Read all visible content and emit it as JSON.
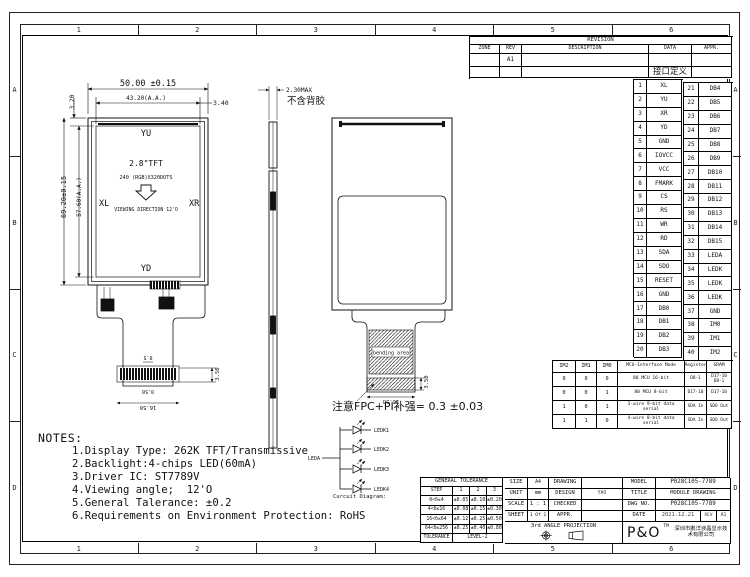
{
  "frame": {
    "top_refs": [
      "1",
      "2",
      "3",
      "4",
      "5",
      "6"
    ],
    "bottom_refs": [
      "1",
      "2",
      "3",
      "4",
      "5",
      "6"
    ],
    "left_refs": [
      "A",
      "B",
      "C",
      "D"
    ],
    "right_refs": [
      "A",
      "B",
      "C",
      "D"
    ]
  },
  "revision_table": {
    "title": "REVISION",
    "headers": [
      "ZONE",
      "REV",
      "DESCRIPTION",
      "DATA",
      "APPR."
    ],
    "row1_rev": "A1",
    "row2_data": "接口定义"
  },
  "pin_table": {
    "rows": [
      [
        "1",
        "XL",
        "21",
        "DB4"
      ],
      [
        "2",
        "YU",
        "22",
        "DB5"
      ],
      [
        "3",
        "XR",
        "23",
        "DB6"
      ],
      [
        "4",
        "YD",
        "24",
        "DB7"
      ],
      [
        "5",
        "GND",
        "25",
        "DB8"
      ],
      [
        "6",
        "IOVCC",
        "26",
        "DB9"
      ],
      [
        "7",
        "VCC",
        "27",
        "DB10"
      ],
      [
        "8",
        "FMARK",
        "28",
        "DB11"
      ],
      [
        "9",
        "CS",
        "29",
        "DB12"
      ],
      [
        "10",
        "RS",
        "30",
        "DB13"
      ],
      [
        "11",
        "WR",
        "31",
        "DB14"
      ],
      [
        "12",
        "RD",
        "32",
        "DB15"
      ],
      [
        "13",
        "SDA",
        "33",
        "LEDA"
      ],
      [
        "14",
        "SDO",
        "34",
        "LEDK"
      ],
      [
        "15",
        "RESET",
        "35",
        "LEDK"
      ],
      [
        "16",
        "GND",
        "36",
        "LEDK"
      ],
      [
        "17",
        "DB0",
        "37",
        "GND"
      ],
      [
        "18",
        "DB1",
        "38",
        "IM0"
      ],
      [
        "19",
        "DB2",
        "39",
        "IM1"
      ],
      [
        "20",
        "DB3",
        "40",
        "IM2"
      ]
    ]
  },
  "mcu_table": {
    "headers": [
      "IM2",
      "IM1",
      "IM0",
      "MCU-Interface Mode",
      "Register",
      "GRAM"
    ],
    "rows": [
      [
        "0",
        "0",
        "0",
        "80 MCU 16-bit",
        "D8-1",
        "D17-10\nD8-1"
      ],
      [
        "0",
        "0",
        "1",
        "80 MCU 8-bit",
        "D17-10",
        "D17-10"
      ],
      [
        "1",
        "0",
        "1",
        "3-wire 9-bit data serial",
        "SDA In",
        "SDO Out"
      ],
      [
        "1",
        "1",
        "0",
        "4-wire 8-bit data serial",
        "SDA In",
        "SDO Out"
      ]
    ]
  },
  "front_view": {
    "dim_width": "50.00 ±0.15",
    "dim_aa_width": "43.20(A.A.)",
    "dim_right_margin": "3.40",
    "dim_top_margin": "3.20",
    "dim_height": "69.20±0.15",
    "dim_aa_height": "57.60(A.A.)",
    "label_top": "YU",
    "label_left": "XL",
    "label_right": "XR",
    "label_bottom": "YD",
    "center_line1": "2.8\"TFT",
    "center_line2": "240 (RGB)X320DOTS",
    "center_line3": "VIEWING DIRECTION 12'O",
    "fpc_pitch": "0.5",
    "fpc_pitch2": "0.50",
    "fpc_connector_width": "16.50",
    "fpc_connector_height": "3.50"
  },
  "side_view": {
    "dim_thickness": "2.30MAX",
    "note": "不含背胶"
  },
  "back_view": {
    "bending_label": "bending area",
    "dim_connector_width": "16.50",
    "dim_connector_height": "3.50",
    "fpc_note": "注意FPC+PI补强= 0.3 ±0.03"
  },
  "circuit": {
    "caption": "Curcuit Diagram:",
    "anode": "LEDA",
    "cathodes": [
      "LEDK1",
      "LEDK2",
      "LEDK3",
      "LEDK4"
    ]
  },
  "notes": {
    "title": "NOTES:",
    "items": [
      "1.Display Type: 262K TFT/Transmissive",
      "2.Backlight:4-chips LED(60mA)",
      "3.Driver IC: ST7789V",
      "4.Viewing angle;  12'O",
      "5.General Talerance: ±0.2",
      "6.Requirements on Environment Protection: RoHS"
    ]
  },
  "title_block": {
    "tolerance": {
      "header": "GENERAL TOLERANCE",
      "col_headers": [
        "STEP",
        "1",
        "2",
        "3"
      ],
      "rows": [
        [
          "0<δ≤4",
          "±0.05",
          "±0.10",
          "±0.20"
        ],
        [
          "4<δ≤16",
          "±0.08",
          "±0.15",
          "±0.30"
        ],
        [
          "16<δ≤64",
          "±0.12",
          "±0.25",
          "±0.50"
        ],
        [
          "64<δ≤256",
          "±0.25",
          "±0.40",
          "±0.80"
        ]
      ],
      "footer_label": "TOLERANCE",
      "footer_value": "LEVEL-2"
    },
    "size_label": "SIZE",
    "size_value": "A4",
    "unit_label": "UNIT",
    "unit_value": "mm",
    "scale_label": "SCALE",
    "scale_value": "1 : 1",
    "sheet_label": "SHEET",
    "sheet_value": "1 Of 1",
    "projection": "3rd ANGLE PROJECTION",
    "drawing_label": "DRAWING",
    "drawing_value": "",
    "design_label": "DESIGN",
    "design_value": "YAO",
    "checked_label": "CHECKED",
    "checked_value": "",
    "appr_label": "APPR.",
    "appr_value": "",
    "model_label": "MODEL",
    "model_value": "P028C105-7789",
    "title_label": "TITLE",
    "title_value": "MODULE DRAWING",
    "dwgno_label": "DWG NO.",
    "dwgno_value": "P028C105-7789",
    "date_label": "DATE",
    "date_value": "2021.12.21",
    "rev_label": "REV",
    "rev_value": "A1",
    "logo": "P&O",
    "logo_tm": "TM",
    "company": "深圳市鹏洋液晶显示技术有限公司"
  }
}
